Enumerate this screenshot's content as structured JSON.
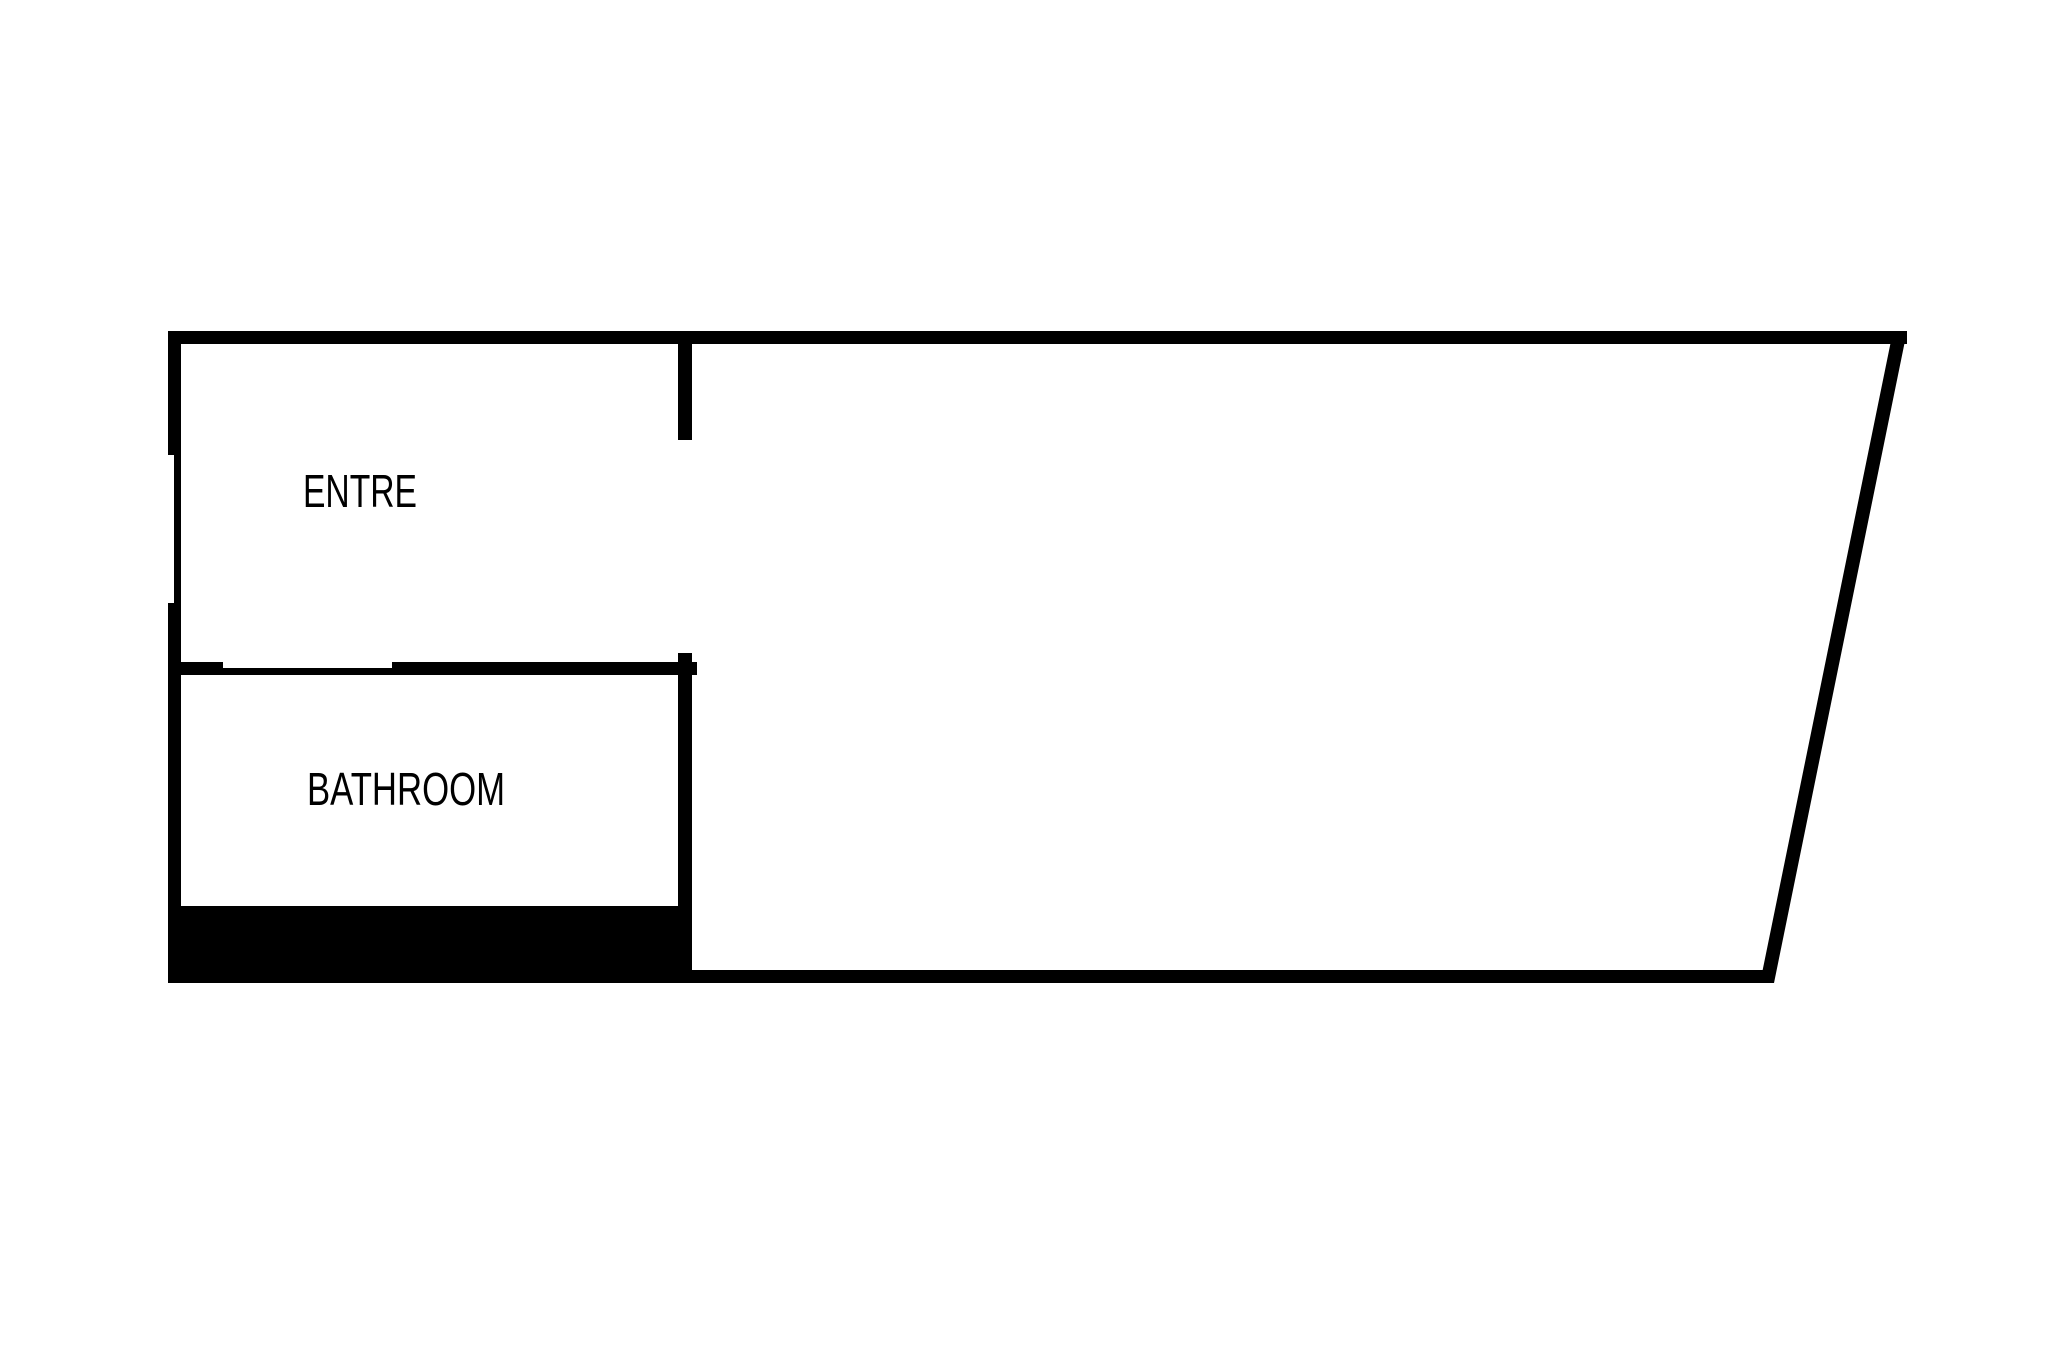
{
  "floorplan": {
    "rooms": [
      {
        "id": "entre",
        "label": "ENTRE"
      },
      {
        "id": "bathroom",
        "label": "BATHROOM"
      }
    ],
    "colors": {
      "wall": "#000000",
      "background": "#ffffff",
      "text": "#000000"
    }
  }
}
